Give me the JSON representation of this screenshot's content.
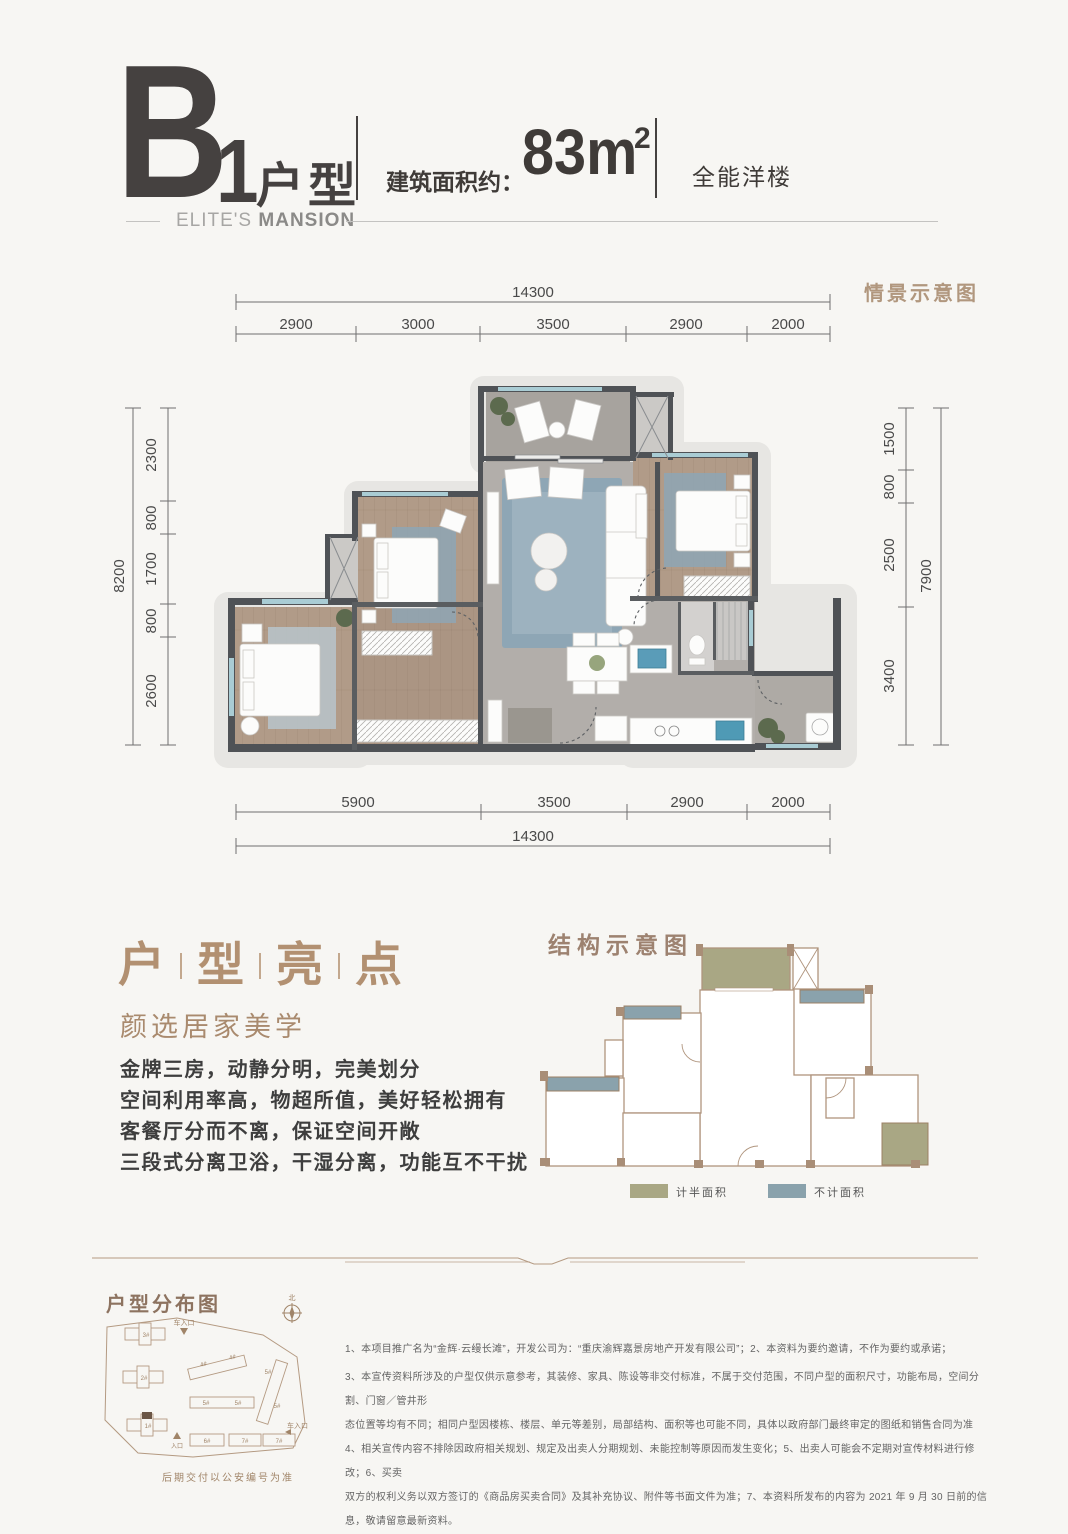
{
  "header": {
    "plan_letter": "B",
    "plan_number": "1",
    "plan_type": "户型",
    "area_label": "建筑面积约：",
    "area_value": "83m",
    "area_exponent": "2",
    "category": "全能洋楼",
    "brand_light": "ELITE'S ",
    "brand_bold": "MANSION"
  },
  "floor_plan": {
    "scene_label": "情景示意图",
    "dims": {
      "top_total": "14300",
      "top_segments": [
        "2900",
        "3000",
        "3500",
        "2900",
        "2000"
      ],
      "bottom_segments": [
        "5900",
        "3500",
        "2900",
        "2000"
      ],
      "bottom_total": "14300",
      "left_outer": "8200",
      "left_segments": [
        "2300",
        "800",
        "1700",
        "800",
        "2600"
      ],
      "right_segments": [
        "1500",
        "800",
        "2500",
        "3400"
      ],
      "right_outer": "7900"
    }
  },
  "highlights": {
    "title_chars": [
      "户",
      "型",
      "亮",
      "点"
    ],
    "subtitle": "颜选居家美学",
    "bullets": [
      "金牌三房，动静分明，完美划分",
      "空间利用率高，物超所值，美好轻松拥有",
      "客餐厅分而不离，保证空间开敞",
      "三段式分离卫浴，干湿分离，功能互不干扰"
    ]
  },
  "structure": {
    "heading": "结构示意图",
    "legend": [
      {
        "label": "计半面积",
        "color": "#a9a784"
      },
      {
        "label": "不计面积",
        "color": "#8aa2ac"
      }
    ]
  },
  "site_map": {
    "heading": "户型分布图",
    "caption": "后期交付以公安编号为准",
    "north_label": "北",
    "entrance_top": "车入口",
    "entrance_right": "车入口",
    "entrance_bottom": "入口",
    "building_labels": [
      "3#",
      "2#",
      "1#",
      "4#",
      "4#",
      "5#",
      "5#",
      "5#",
      "5#",
      "6#",
      "7#",
      "7#"
    ]
  },
  "disclaimer": {
    "lines": [
      "1、本项目推广名为“金辉·云缦长滩”，开发公司为：“重庆渝辉嘉景房地产开发有限公司”；2、本资料为要约邀请，不作为要约或承诺；",
      "3、本宣传资料所涉及的户型仅供示意参考，其装修、家具、陈设等非交付标准，不属于交付范围，不同户型的面积尺寸，功能布局，空间分割、门窗／管井形",
      "态位置等均有不同；相同户型因楼栋、楼层、单元等差别，局部结构、面积等也可能不同，具体以政府部门最终审定的图纸和销售合同为准",
      "4、相关宣传内容不排除因政府相关规划、规定及出卖人分期规划、未能控制等原因而发生变化；5、出卖人可能会不定期对宣传材料进行修改；6、买卖",
      "双方的权利义务以双方签订的《商品房买卖合同》及其补充协议、附件等书面文件为准；7、本资料所发布的内容为 2021 年 9 月 30 日前的信息，敬请留意最新资料。"
    ]
  },
  "colors": {
    "accent_tan": "#b1977e",
    "heading_dark": "#454140",
    "half_area_olive": "#a9a784",
    "uncounted_blue": "#8aa2ac",
    "window_teal": "#a9ccd4",
    "wall_dark": "#4f5256"
  }
}
